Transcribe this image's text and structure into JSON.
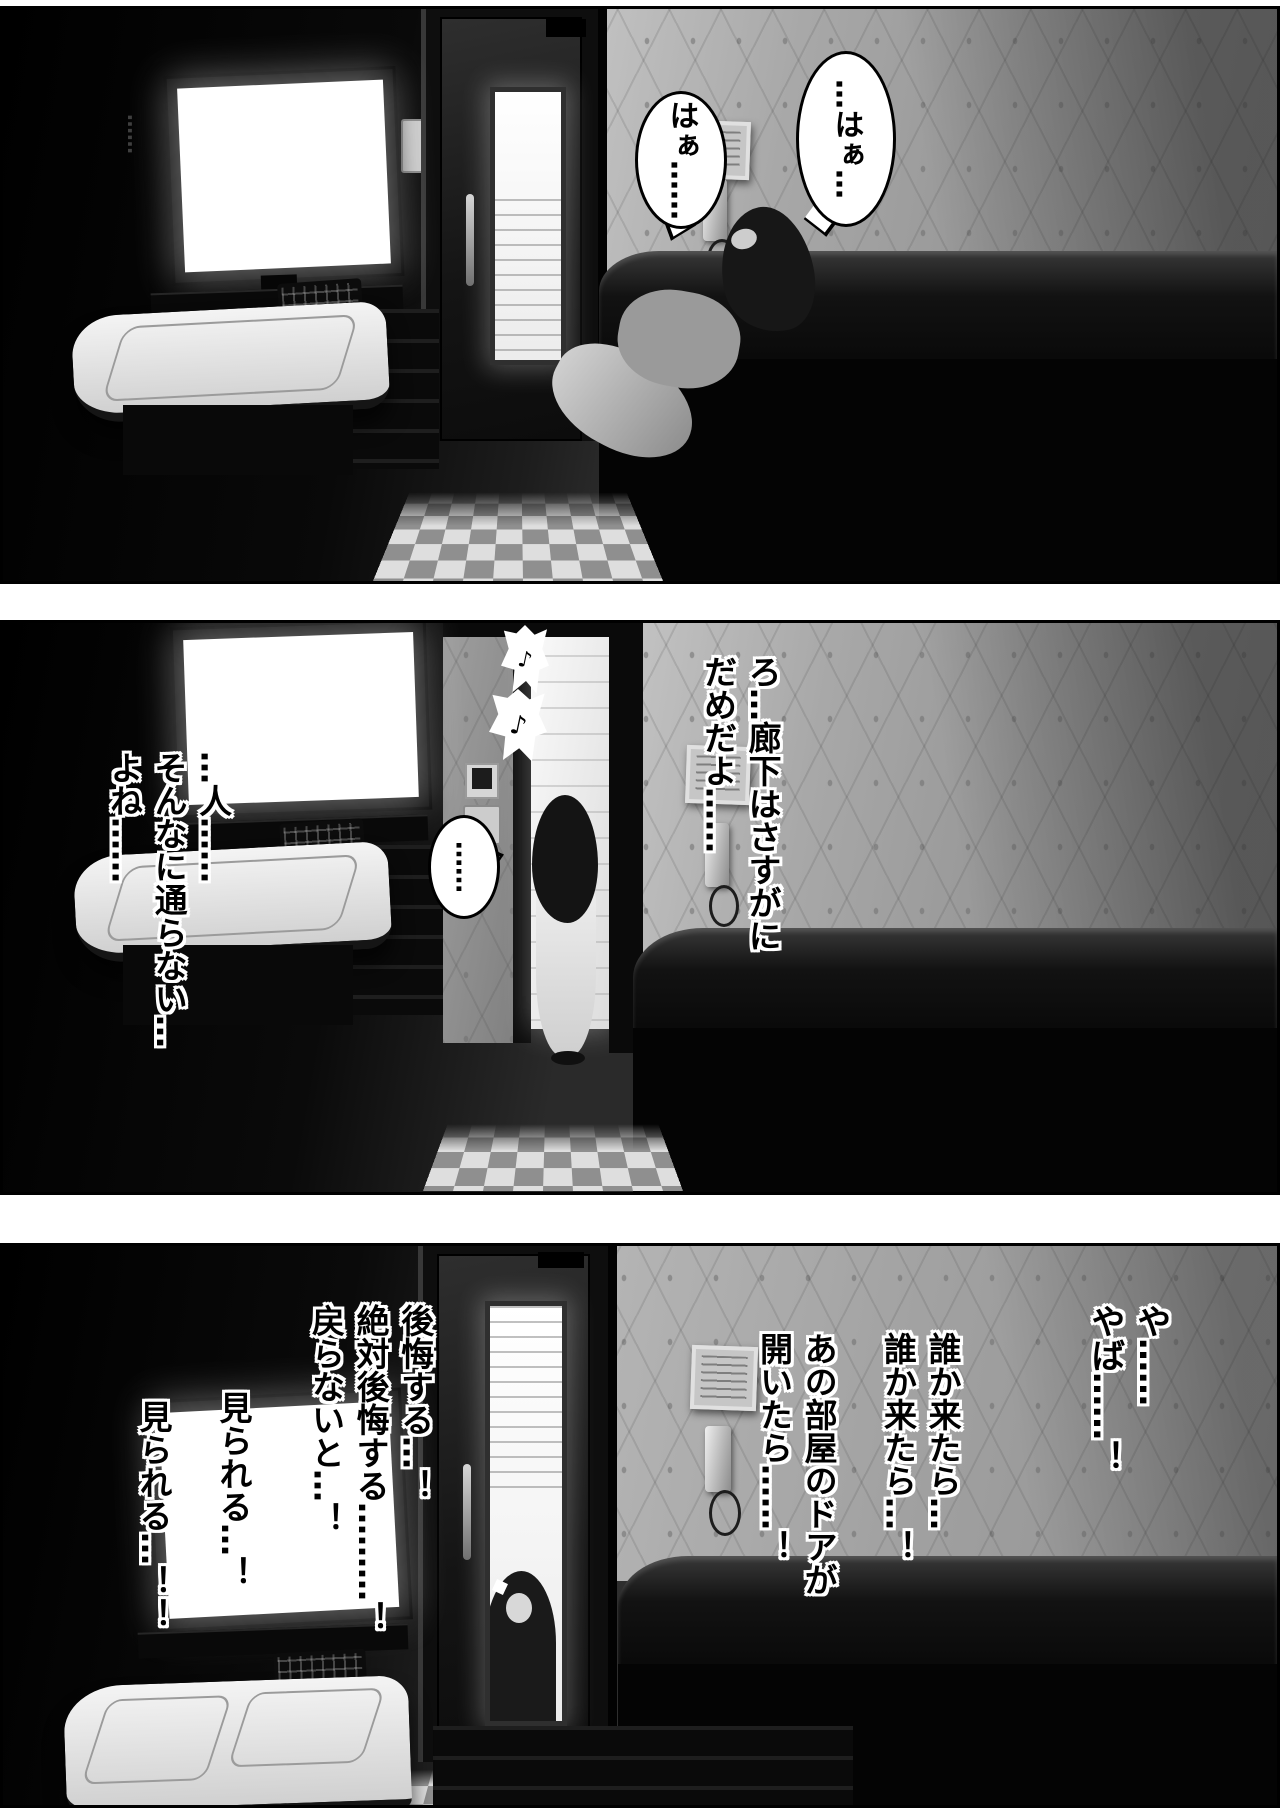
{
  "page": {
    "type": "manga-page",
    "panel_count": 3
  },
  "colors": {
    "paper": "#ffffff",
    "ink": "#000000",
    "wallpaper": "#9c9c9c",
    "screen_glow": "#ffffff"
  },
  "panel1": {
    "ambient_ellipsis": "……",
    "bubble_right": "…はぁ…",
    "bubble_left": "はぁ……"
  },
  "panel2": {
    "music_note": "♪",
    "dialogue_right": [
      "ろ…廊下はさすがに",
      "だめだよ……"
    ],
    "dialogue_left": [
      "…人……",
      "そんなに通らない…",
      "よね……"
    ],
    "bubble": "……"
  },
  "panel3": {
    "dialogue_far_right": [
      "や……",
      "やば……！"
    ],
    "dialogue_right": [
      "誰か来たら…",
      "誰か来たら…！"
    ],
    "dialogue_mid": [
      "あの部屋のドアが",
      "開いたら……！"
    ],
    "dialogue_left": [
      "後悔する…！",
      "絶対後悔する………！",
      "戻らないと…！"
    ],
    "dialogue_far_left_1": "見られる…！",
    "dialogue_far_left_2": "見られる…！！"
  }
}
